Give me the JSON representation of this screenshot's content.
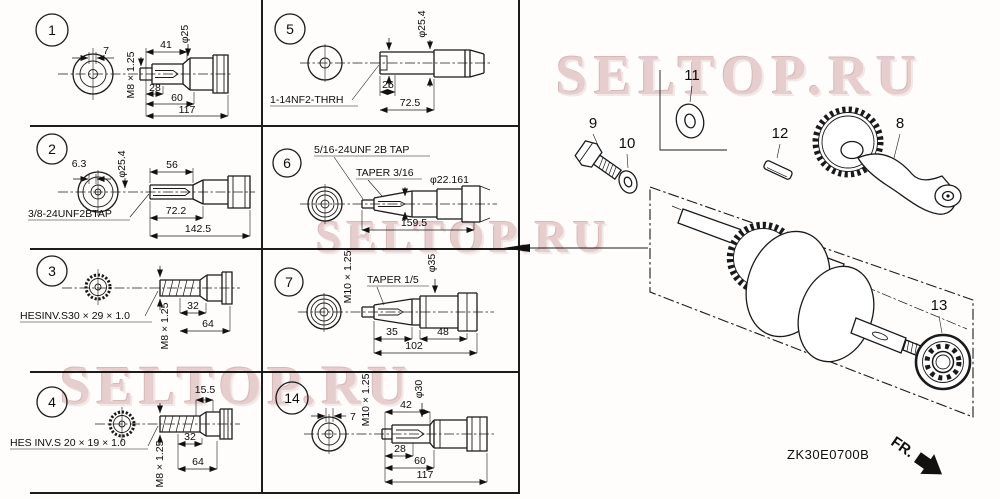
{
  "watermark": {
    "text": "SELTOP.RU"
  },
  "footer": {
    "code": "ZK30E0700B",
    "fr": "FR."
  },
  "parts": {
    "p8": "8",
    "p9": "9",
    "p10": "10",
    "p11": "11",
    "p12": "12",
    "p13": "13"
  },
  "cells": {
    "c1": {
      "num": "1",
      "d7": "7",
      "thread": "M8 × 1.25",
      "a": "41",
      "dia": "φ25",
      "b": "28",
      "c": "60",
      "t": "117"
    },
    "c5": {
      "num": "5",
      "dia": "φ25.4",
      "a": "26",
      "t": "72.5",
      "note": "1-14NF2-THRH"
    },
    "c2": {
      "num": "2",
      "end": "6.3",
      "dia": "φ25.4",
      "a": "56",
      "b": "72.2",
      "t": "142.5",
      "note": "3/8-24UNF2BTAP"
    },
    "c6": {
      "num": "6",
      "note": "5/16-24UNF 2B TAP",
      "taper": "TAPER 3/16",
      "dia": "φ22.161",
      "t": "159.5"
    },
    "c3": {
      "num": "3",
      "note": "HESINV.S30 × 29 × 1.0",
      "thread": "M8 × 1.25",
      "a": "32",
      "b": "64"
    },
    "c7": {
      "num": "7",
      "thread": "M10 × 1.25",
      "taper": "TAPER 1/5",
      "dia": "φ35",
      "a": "35",
      "b": "48",
      "t": "102"
    },
    "c4": {
      "num": "4",
      "note": "HES INV.S 20 × 19 × 1.0",
      "end": "15.5",
      "thread": "M8 × 1.25",
      "a": "32",
      "b": "64"
    },
    "c14": {
      "num": "14",
      "d7": "7",
      "thread": "M10 × 1.25",
      "a": "42",
      "dia": "φ30",
      "b": "28",
      "c": "60",
      "t": "117"
    }
  }
}
